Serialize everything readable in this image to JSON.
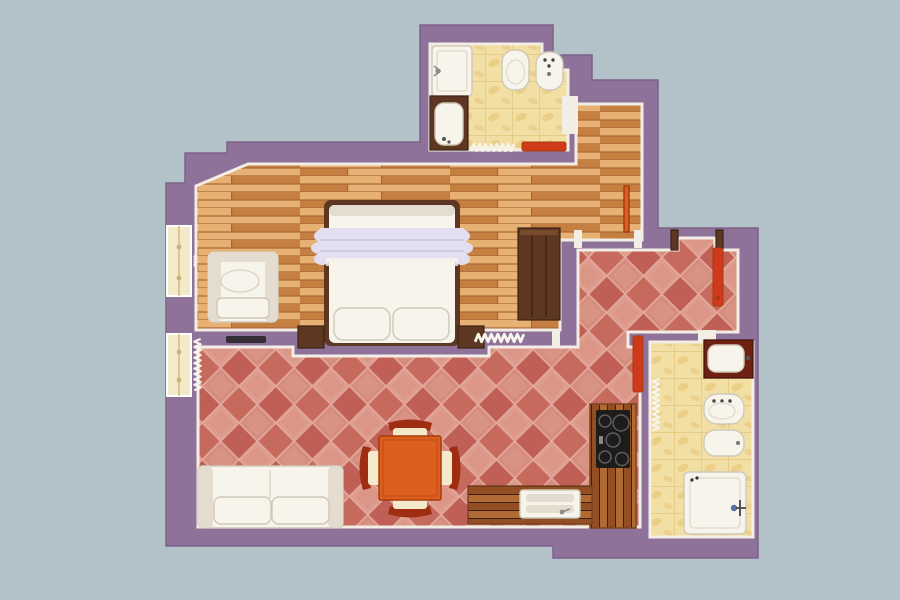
{
  "title": "3D floor plan of a one-bedroom apartment, top view",
  "palette": {
    "bg": "#b3c2c9",
    "wall": "#8f7299",
    "wall-edge": "#7c6187",
    "outline": "#f2eee6",
    "wood-a": "#e7b173",
    "wood-b": "#d3904f",
    "wood-c": "#c57f41",
    "wood-line": "#a96736",
    "tile-a": "#d68d80",
    "tile-b": "#c66a5e",
    "tile-c": "#dd9c8e",
    "tile-d": "#bf5f55",
    "tile-grout": "#e5ab9e",
    "yellow-tile": "#f2dfa4",
    "yellow-line": "#dcba6a",
    "yellow-vein": "#e5c06f",
    "counter-a": "#b06a33",
    "counter-b": "#934f23",
    "dark-wood": "#5e3722",
    "darker-wood": "#3c2113",
    "fixture": "#f7f4ec",
    "fixture-edge": "#cfc8b8",
    "fixture-shade": "#e4ddcf",
    "orange": "#dd5f1d",
    "orange-dark": "#a63c0e",
    "door-red": "#cf3a1a",
    "ruffle": "#e3def0",
    "black": "#1d1c1a",
    "cream": "#f4e9c8"
  },
  "scene": {
    "rooms": [
      {
        "id": "bedroom",
        "floor": "wood-planks",
        "furniture": [
          "double-bed",
          "pillows",
          "armchair",
          "wardrobe",
          "nightstands",
          "window",
          "radiator"
        ]
      },
      {
        "id": "living-room-kitchen",
        "floor": "red-diagonal-tiles",
        "furniture": [
          "sofa",
          "dining-table",
          "dining-chairs",
          "kitchen-counter",
          "cooktop",
          "kitchen-sink",
          "window",
          "radiator",
          "tv-shelf"
        ]
      },
      {
        "id": "bathroom-top",
        "floor": "yellow-marble-tiles",
        "furniture": [
          "shower-tray",
          "sink-vanity",
          "toilet",
          "bidet",
          "radiator",
          "red-mat"
        ]
      },
      {
        "id": "bathroom-right",
        "floor": "yellow-marble-tiles",
        "furniture": [
          "sink-vanity",
          "toilet",
          "bidet",
          "shower-tray",
          "radiator"
        ]
      },
      {
        "id": "entry-hall",
        "floor": "red-diagonal-tiles",
        "furniture": [
          "entry-door-open"
        ]
      },
      {
        "id": "corridor",
        "floor": "wood-planks",
        "furniture": [
          "door-leaf"
        ]
      }
    ]
  }
}
